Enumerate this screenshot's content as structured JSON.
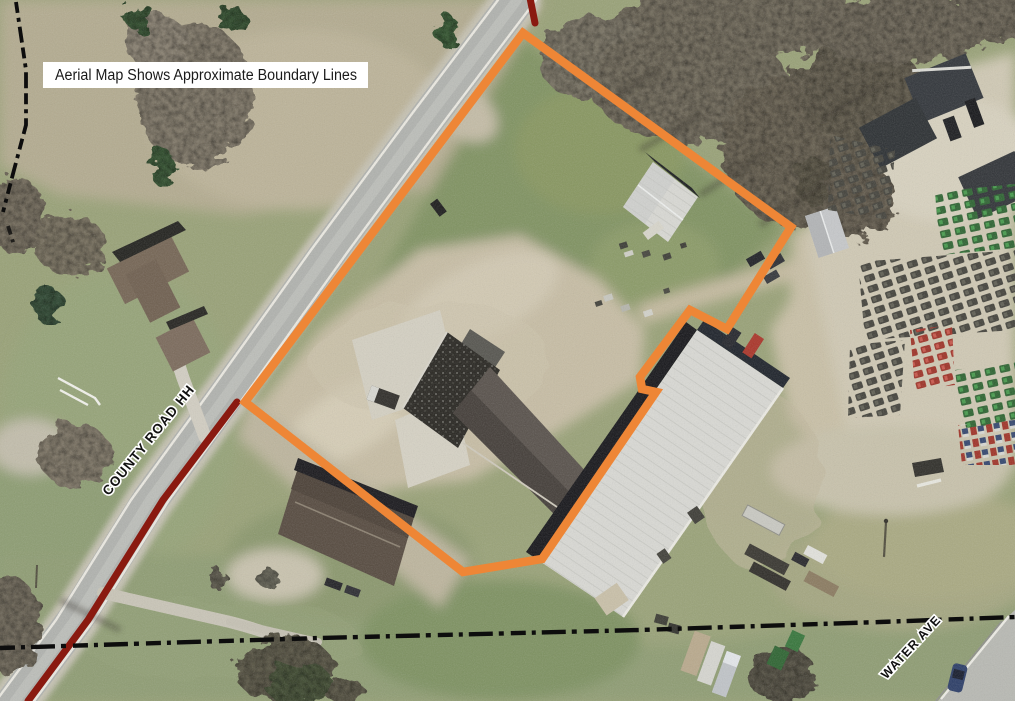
{
  "annotation": {
    "text": "Aerial Map Shows Approximate Boundary Lines"
  },
  "labels": {
    "county_road": "COUNTY ROAD HH",
    "water_ave": "WATER AVE"
  },
  "boundary": {
    "color": "#ee8636",
    "points": "523,33 791,227 727,329 690,310 640,377 642,389 656,392 542,559 463,572 245,402"
  },
  "overlays": {
    "road_line_color": "#8a1a10",
    "section_line_color": "#0d0d0d"
  }
}
